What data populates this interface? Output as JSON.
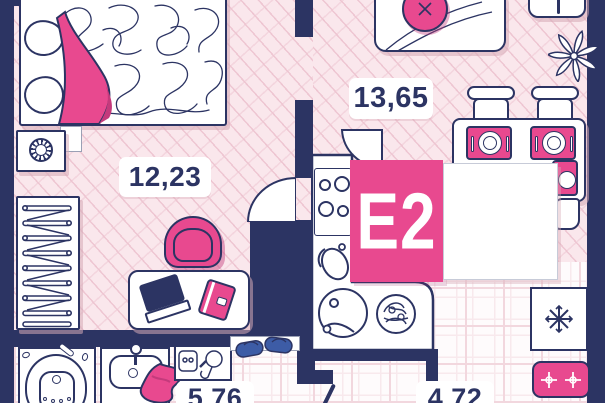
{
  "unit": {
    "code": "E2"
  },
  "rooms": [
    {
      "name": "bedroom",
      "area_label": "12,23"
    },
    {
      "name": "kitchen_living",
      "area_label": "13,65"
    },
    {
      "name": "bathroom",
      "area_label": "5,76"
    },
    {
      "name": "hallway",
      "area_label": "4,72"
    }
  ],
  "colors": {
    "wall": "#2c3463",
    "accent_pink": "#e8498f",
    "accent_pink_dark": "#c43a7c",
    "floor_pink": "#fae7ec",
    "hatch_line": "#eec6d2",
    "tile_line": "#f2d7de",
    "tile_inner": "#f8e9ed",
    "box_border": "#c7cbd8",
    "slipper_blue": "#3d5ca6"
  },
  "icons": {
    "fridge": "snowflake-icon",
    "entry_mat": "double-crosshair-icon",
    "decor_plant": "flower-icon",
    "nightstand_decor": "round-ribbed-icon",
    "wardrobe": "hangers-icon"
  }
}
